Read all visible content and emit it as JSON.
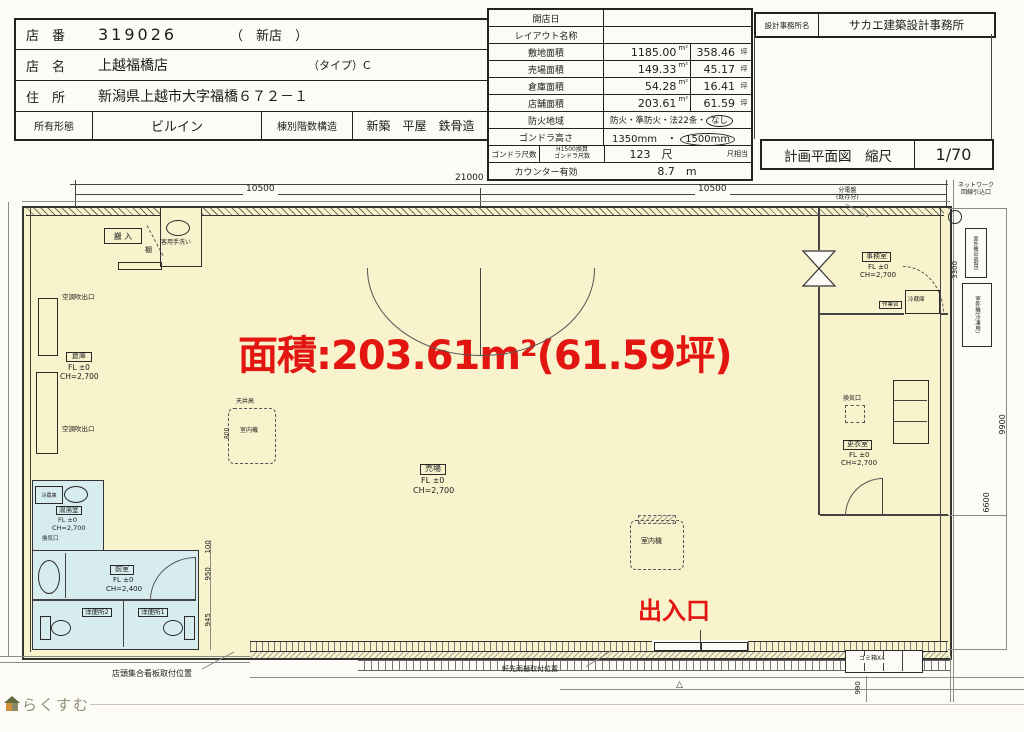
{
  "store": {
    "row1": {
      "label": "店　番",
      "value": "319026",
      "extra": "（　新店　）"
    },
    "row2": {
      "label": "店　名",
      "value": "上越福橋店",
      "extra": "（タイプ）C"
    },
    "row3": {
      "label": "住　所",
      "value": "新潟県上越市大字福橋６７２－１"
    },
    "row4": {
      "c1": "所有形態",
      "c2": "ビルイン",
      "c3": "棟別階数構造",
      "c4": "新築　平屋　鉄骨造"
    }
  },
  "spec": {
    "units": {
      "m2": "m²",
      "tsubo": "坪"
    },
    "open_date": {
      "label": "開店日"
    },
    "layout": {
      "label": "レイアウト名称"
    },
    "site": {
      "label": "敷地面積",
      "m2": "1185.00",
      "tsubo": "358.46"
    },
    "sales": {
      "label": "売場面積",
      "m2": "149.33",
      "tsubo": "45.17"
    },
    "warehouse": {
      "label": "倉庫面積",
      "m2": "54.28",
      "tsubo": "16.41"
    },
    "store_area": {
      "label": "店舗面積",
      "m2": "203.61",
      "tsubo": "61.59"
    },
    "fire": {
      "label": "防火地域",
      "value": "防火・準防火・法22条・",
      "circled": "なし"
    },
    "gondola_h": {
      "label": "ゴンドラ高さ",
      "value": "1350mm　・",
      "circled": "1500mm"
    },
    "gondola_s": {
      "label": "ゴンドラ尺数",
      "sublabel1": "H1500換算",
      "sublabel2": "ゴンドラ尺数",
      "value": "123　尺",
      "note": "尺相当"
    },
    "counter": {
      "label": "カウンター有効",
      "value": "8.7　m"
    }
  },
  "titleblock": {
    "office_label": "設計事務所名",
    "office_value": "サカエ建築設計事務所",
    "drawing_label": "計画平面図　縮尺",
    "scale_value": "1/70"
  },
  "plan": {
    "area_text": "面積:203.61m²(61.59坪)",
    "entrance_text": "出入口",
    "dims": {
      "total": "21000",
      "left": "10500",
      "right": "10500",
      "v3300": "3300",
      "v9900": "9900",
      "v6600": "6600",
      "t100": "100",
      "t950": "950",
      "t945": "945",
      "trash": "990",
      "ceil": "800"
    },
    "rooms": {
      "uriba": {
        "name": "売場",
        "fl": "FL ±0",
        "ch": "CH=2,700"
      },
      "souko": {
        "name": "倉庫",
        "fl": "FL ±0",
        "ch": "CH=2,700"
      },
      "jimu": {
        "name": "事務室",
        "fl": "FL ±0",
        "ch": "CH=2,700"
      },
      "koui": {
        "name": "更衣室",
        "fl": "FL ±0",
        "ch": "CH=2,700"
      },
      "yuwakashi": {
        "name": "湯沸室",
        "fl": "FL ±0",
        "ch": "CH=2,700"
      },
      "zenshitsu": {
        "name": "前室",
        "fl": "FL ±0",
        "ch": "CH=2,400"
      },
      "wc2": "洋便所2",
      "wc1": "洋便所1"
    },
    "labels": {
      "hannyu": "搬 入",
      "tearai": "客用手洗い",
      "tana": "棚",
      "duct1": "空調吹出口",
      "duct2": "空調吹出口",
      "tenjo": "天井高",
      "indoor1": "室内機",
      "indoor2": "室内機",
      "kanki": "換気口",
      "reizo1": "冷蔵庫",
      "reizo2": "冷蔵庫",
      "sagyodai": "作業台",
      "bunden1": "分電盤",
      "bunden2": "(既存分)",
      "net1": "ネットワーク",
      "net2": "回線引込口",
      "outA": "室外機(空調用)",
      "outB": "室外機(冷凍用)",
      "gomi": "ゴミ箱X4",
      "kanban": "店頭集合看板取付位置",
      "amadoi": "軒先雨樋取付位置"
    }
  },
  "watermark": {
    "text": "らくすむ"
  }
}
